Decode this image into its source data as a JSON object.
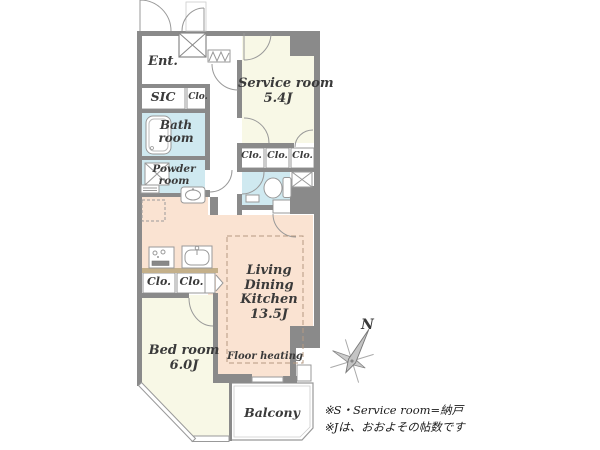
{
  "colors": {
    "wall": "#8a8a8a",
    "ldk_floor": "#fae3d2",
    "room_floor": "#f8f8e6",
    "wet_floor": "#cfe9f0",
    "closet_fill": "#d9c8a5",
    "counter_fill": "#c4b08a",
    "line": "#999999"
  },
  "rooms": {
    "entrance": "Ent.",
    "sic": "SIC",
    "closet": "Clo.",
    "bathroom": "Bath room",
    "powder_room": "Powder room",
    "service_room": "Service room",
    "service_room_size": "5.4J",
    "ldk": "Living Dining Kitchen",
    "ldk_size": "13.5J",
    "floor_heating": "Floor heating",
    "bedroom": "Bed room",
    "bedroom_size": "6.0J",
    "balcony": "Balcony"
  },
  "compass": {
    "north": "N"
  },
  "notes": {
    "line1": "※S・Service room=納戸",
    "line2": "※Jは、おおよその帖数です"
  }
}
